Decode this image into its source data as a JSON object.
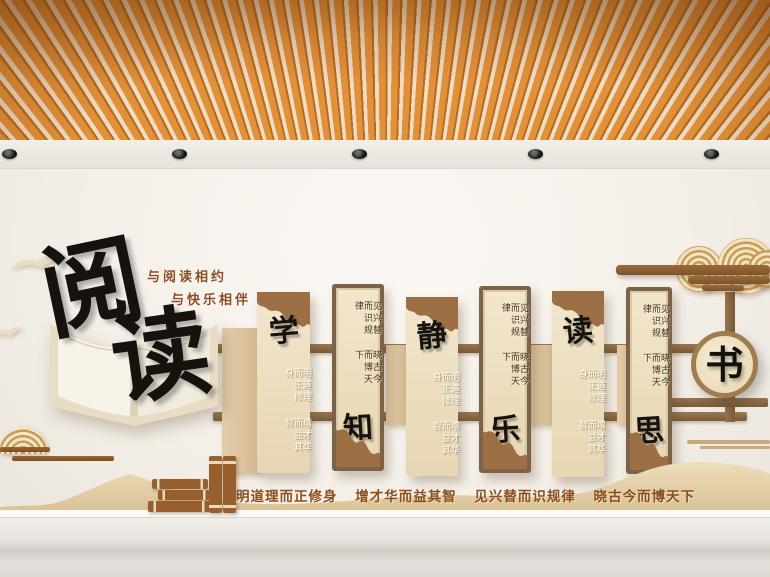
{
  "headline": {
    "main_chars": [
      "阅",
      "读"
    ],
    "tagline_line1": "与阅读相约",
    "tagline_line2": "与快乐相伴"
  },
  "panels": [
    {
      "char": "学",
      "style": "plain",
      "column_right": "明道理而正修身",
      "column_left": "增才华而益其智"
    },
    {
      "char": "知",
      "style": "framed",
      "column_right": "见兴替而识规律",
      "column_left": "晓古今而博天下"
    },
    {
      "char": "静",
      "style": "plain",
      "column_right": "明道理而正修身",
      "column_left": "增才华而益其智"
    },
    {
      "char": "乐",
      "style": "framed",
      "column_right": "见兴替而识规律",
      "column_left": "晓古今而博天下"
    },
    {
      "char": "读",
      "style": "plain",
      "column_right": "明道理而正修身",
      "column_left": "增才华而益其智"
    },
    {
      "char": "思",
      "style": "framed",
      "column_right": "见兴替而识规律",
      "column_left": "晓古今而博天下"
    }
  ],
  "medallion": {
    "char": "书"
  },
  "slogan_phrases": [
    "明道理而正修身",
    "增才华而益其智",
    "见兴替而识规律",
    "晓古今而博天下"
  ],
  "ceiling": {
    "light_count": 5
  },
  "palette": {
    "ceiling_orange": "#E2913B",
    "wood_brown": "#9D6F45",
    "panel_cream": "#EFE2C8",
    "frame_brown": "#7B6248",
    "calligraphy_black": "#17120D",
    "tagline_brown": "#8A4F28",
    "slogan_brown": "#8A4E1F",
    "band_tan": "#E5D3AD"
  }
}
